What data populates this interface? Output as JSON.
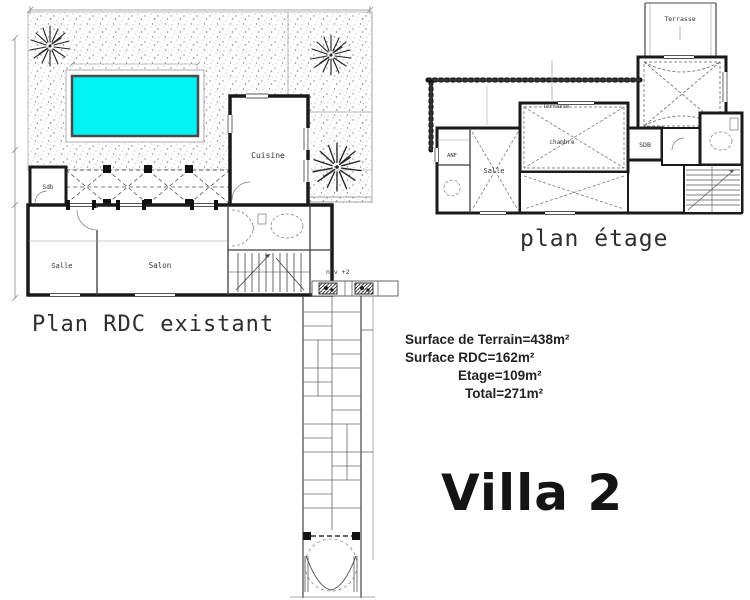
{
  "rdc": {
    "title": "Plan RDC existant",
    "rooms": {
      "cuisine": "Cuisine",
      "sdb": "Sdb",
      "salle": "Salle",
      "salon": "Salon"
    },
    "level_note": "niv +2"
  },
  "etage": {
    "title": "plan étage",
    "rooms": {
      "terrasse_top": "Terrasse",
      "terrasse_mid": "Terrasse",
      "anf": "ANF",
      "salle": "Salle",
      "chambre": "chambre",
      "sdb": "SDB"
    }
  },
  "summary": {
    "terrain": "Surface de Terrain=438m²",
    "rdc": "Surface RDC=162m²",
    "etage": "Etage=109m²",
    "total": "Total=271m²"
  },
  "villa_title": "Villa 2",
  "colors": {
    "pool": "#00F2F2",
    "wall_ink": "#1a1a1a",
    "text_ink": "#222222"
  }
}
